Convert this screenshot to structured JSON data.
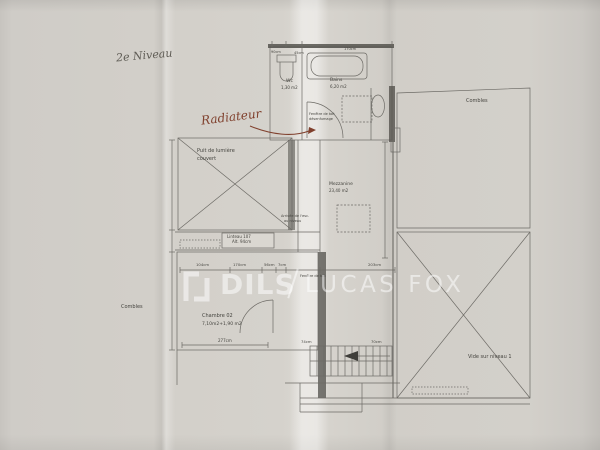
{
  "handwriting": {
    "level_note": "2e Niveau",
    "radiator_note": "Radiateur"
  },
  "watermark": {
    "brand_left": "DILS",
    "brand_right": "LUCAS FOX"
  },
  "rooms": {
    "wc": {
      "name": "Wc",
      "area": "1,30 m2"
    },
    "bains": {
      "name": "Bains",
      "area": "6,20 m2"
    },
    "mezzanine": {
      "name": "Mezzanine",
      "area": "23,40 m2"
    },
    "chambre": {
      "name": "Chambre 02",
      "area": "7,10m2+1,90 m2"
    },
    "combles_left": {
      "name": "Combles"
    },
    "combles_right": {
      "name": "Combles"
    },
    "vide": {
      "name": "Vide sur niveau 1"
    },
    "puit": {
      "line1": "Puit de lumière",
      "line2": "couvert"
    }
  },
  "annotations": {
    "linteau_line1": "Linteau 107",
    "linteau_line2": "Alt. 94cm",
    "fenetre_bains_line1": "Fenêtre de toit",
    "fenetre_bains_line2": "désenfumage",
    "fenetre_mezz": "Fenêtre de toit",
    "arrivee_line1": "Arrivée de l'esc.",
    "arrivee_line2": "au niveau"
  },
  "dimensions": {
    "top1": "90cm",
    "top2": "45cm",
    "top3": "170cm",
    "mid1": "104cm",
    "mid2": "170cm",
    "mid3": "56cm",
    "mid4": "7cm",
    "mid5": "203cm",
    "chambre_w": "277cm",
    "stair1": "74cm",
    "stair2": "70cm"
  },
  "colors": {
    "paper": "#d5d2cc",
    "ink": "#6c6a65",
    "wall": "#56544f",
    "red_note": "#80402d",
    "watermark": "rgba(255,255,255,0.52)"
  }
}
